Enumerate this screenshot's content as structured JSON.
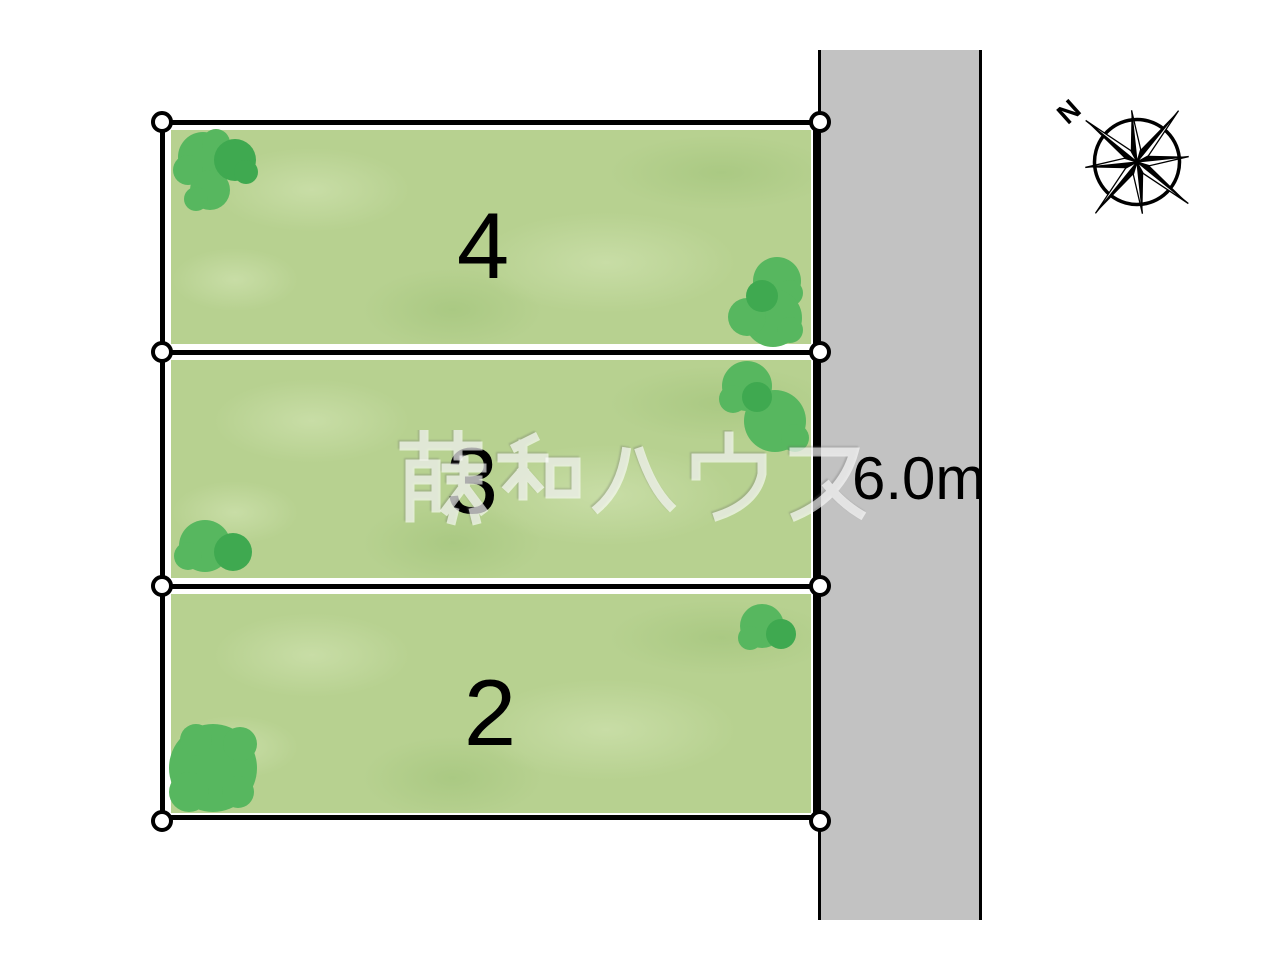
{
  "diagram": {
    "plots": [
      {
        "number": "4"
      },
      {
        "number": "3"
      },
      {
        "number": "2"
      }
    ],
    "road": {
      "width_label": "6.0m"
    },
    "watermark_text": "藤和ハウス",
    "compass_label": "N"
  },
  "colors": {
    "plot_green": "#b7d190",
    "plot_green_light": "#c8dda6",
    "plot_green_dark": "#aac983",
    "tree_light": "#57b75f",
    "tree_dark": "#3fa950",
    "road_gray": "#c2c2c2",
    "line": "#000000"
  }
}
